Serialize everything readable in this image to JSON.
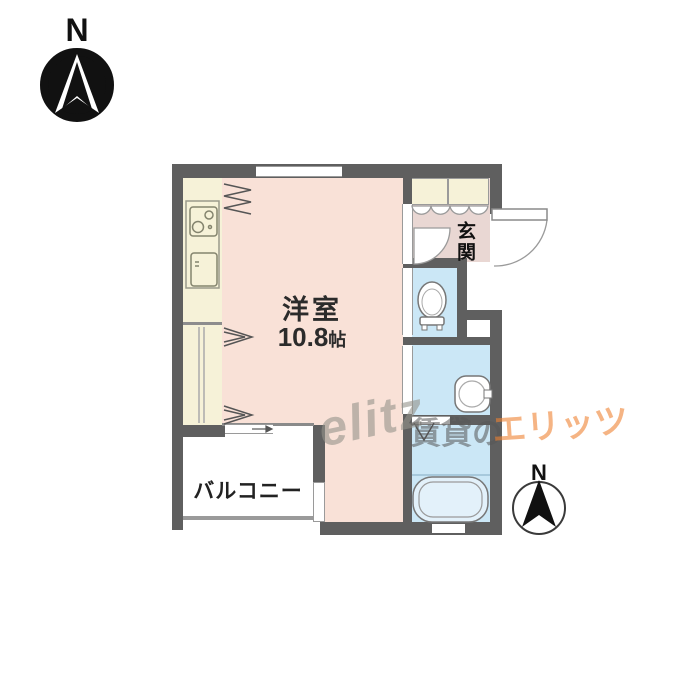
{
  "page": {
    "background": "#ffffff"
  },
  "floor_plan": {
    "rooms": {
      "main_room": {
        "label": "洋室",
        "size_value": "10.8",
        "size_unit": "帖"
      },
      "balcony": {
        "label": "バルコニー"
      },
      "entrance": {
        "label": "玄関"
      }
    },
    "compass_top_left": {
      "label": "N"
    },
    "compass_bottom_right": {
      "label": "N"
    },
    "fixtures": [
      "stove",
      "refrigerator",
      "shoe-cabinet",
      "toilet",
      "washbasin",
      "bathtub",
      "closet",
      "entrance-door",
      "sliding-windows"
    ],
    "colors": {
      "wall": "#5f5f5f",
      "main_room_fill": "#f9e1d7",
      "kitchen_fill": "#f6f2d8",
      "wet_room_fill": "#cbe7f6",
      "entrance_floor_fill": "#e9d7d3",
      "balcony_fill": "#ffffff"
    }
  },
  "watermark": {
    "logo_text": "elitz",
    "gray_text": "賃貸の",
    "orange_text": "エリッツ",
    "orange_color": "#ee8232"
  }
}
